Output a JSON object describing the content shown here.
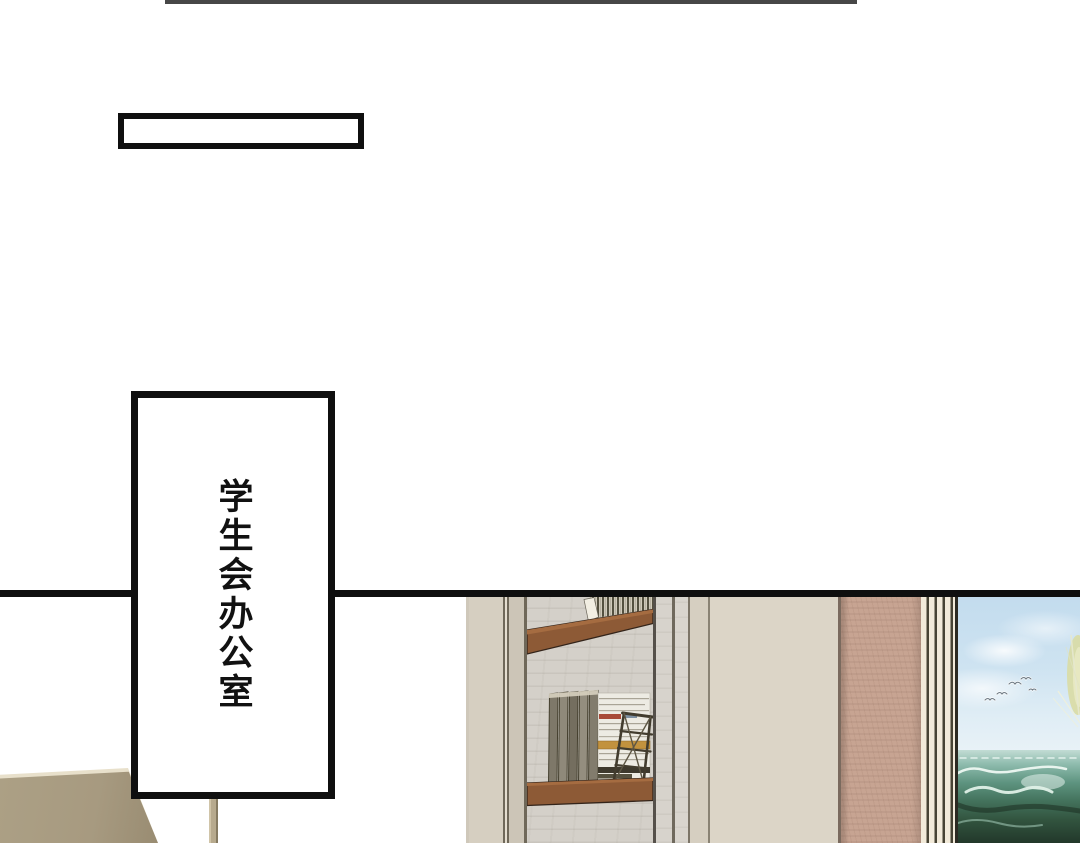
{
  "comic": {
    "caption_box_text": "",
    "door_sign_text": "学生会办公室"
  },
  "scene_objects": [
    "bookshelf-niche",
    "upper-shelf",
    "lower-shelf",
    "standing-books",
    "white-book-stack",
    "magazine-rack",
    "marble-back-wall",
    "beige-wall-panels",
    "stone-pillar",
    "wall-moulding",
    "sea-painting",
    "seagulls",
    "sail-and-rigging",
    "sofa-back",
    "lamp-pole"
  ],
  "palette": {
    "ink": "#0f0f0f",
    "top_rule": "#474747",
    "paper": "#ffffff",
    "wall_beige": "#d6cfc1",
    "wall_beige_2": "#ccc5b7",
    "wall_flat": "#dcd5c7",
    "edge_dark": "#6f6859",
    "marble": "#d4d0c9",
    "shelf_brown": "#8d5a36",
    "shelf_shadow": "#33241a",
    "stone_pink": "#c7a492",
    "moulding_cream": "#f2ead9",
    "moulding_dark": "#474334",
    "frame_dark": "#2c2a22",
    "sky_blue": "#c3dcee",
    "sea_teal": "#5e9480",
    "sea_dark": "#22382a",
    "sail_yellow": "#d9dba4",
    "couch_tan": "#a79a80",
    "couch_highlight": "#e8e0cb",
    "pole_tan": "#b7aa8e"
  }
}
